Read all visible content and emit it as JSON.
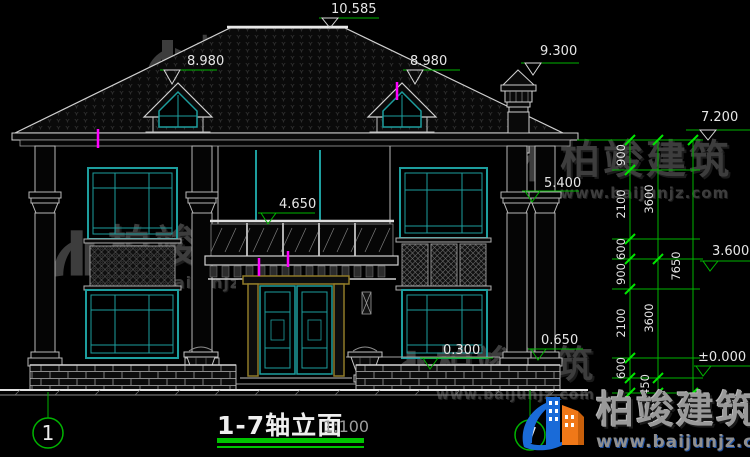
{
  "drawing": {
    "title": "1-7轴立面",
    "scale": "1:100",
    "axis_left": "1",
    "axis_right": "7"
  },
  "watermark": {
    "brand": "柏竣建筑",
    "url": "www.baijunjz.com"
  },
  "elevations": [
    {
      "name": "ridge",
      "value": "10.585"
    },
    {
      "name": "dormer-left",
      "value": "8.980"
    },
    {
      "name": "dormer-right",
      "value": "8.980"
    },
    {
      "name": "chimney",
      "value": "9.300"
    },
    {
      "name": "eave",
      "value": "7.200"
    },
    {
      "name": "column-capital",
      "value": "5.400"
    },
    {
      "name": "balcony-railing",
      "value": "4.650"
    },
    {
      "name": "second-floor",
      "value": "3.600"
    },
    {
      "name": "porch",
      "value": "0.650"
    },
    {
      "name": "window-sill",
      "value": "0.300"
    },
    {
      "name": "ground-floor",
      "value": "±0.000"
    }
  ],
  "dimensions": {
    "inner": [
      "900",
      "2100",
      "600",
      "900",
      "2100",
      "600",
      "450"
    ],
    "middle": [
      "3600",
      "3600"
    ],
    "outer": [
      "7650"
    ]
  },
  "colors": {
    "background": "#000000",
    "linework": "#cfcfcf",
    "window_teal": "#1d9e9e",
    "dimension_green": "#00b400",
    "tick_green": "#00e600",
    "door_frame_olive": "#8f7a28",
    "revision_magenta": "#ff00ff",
    "watermark_gray": "#3d3d3d",
    "logo_blue": "#1a6bd8",
    "logo_orange": "#f07818"
  }
}
